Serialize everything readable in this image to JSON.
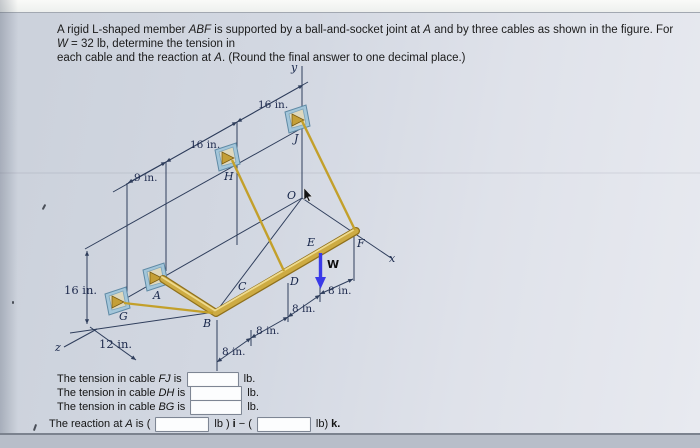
{
  "problem": {
    "l1a": "A rigid L-shaped member ",
    "l1b": "ABF",
    "l1c": " is supported by a ball-and-socket joint at ",
    "l1d": "A",
    "l1e": " and by three cables as shown in the figure. For ",
    "l1f": "W",
    "l1g": " = 32 lb, determine the tension in",
    "l2a": "each cable and the reaction at ",
    "l2b": "A",
    "l2c": ". (Round the final answer to one decimal place.)"
  },
  "figure": {
    "axes": {
      "x": "x",
      "y": "y",
      "z": "z"
    },
    "points": {
      "A": "A",
      "B": "B",
      "C": "C",
      "D": "D",
      "E": "E",
      "F": "F",
      "G": "G",
      "H": "H",
      "J": "J",
      "O": "O"
    },
    "load_label": "W",
    "dims": {
      "d9": "9 in.",
      "d16_top": "16 in.",
      "d16_mid": "16 in.",
      "d16_left": "16 in.",
      "d12": "12 in.",
      "d8_1": "8 in.",
      "d8_2": "8 in.",
      "d8_3": "8 in.",
      "d8_4": "8 in."
    },
    "colors": {
      "line": "#2f3e5c",
      "beam_gold": "#cdab43",
      "beam_edge": "#8f701c",
      "beam_highlight": "#eeda8e",
      "cable": "#c3a02b",
      "anchor_blue": "#a3c6da",
      "anchor_border": "#5f8aa5",
      "anchor_inner": "#ded8bd",
      "bracket_gold": "#c49f37",
      "load_arrow": "#3a3ae8"
    }
  },
  "answers": {
    "row_fj": {
      "prefix": "The tension in cable",
      "cable": "FJ",
      "verb": "is",
      "unit": "lb.",
      "value": ""
    },
    "row_dh": {
      "prefix": "The tension in cable",
      "cable": "DH",
      "verb": "is",
      "unit": "lb.",
      "value": ""
    },
    "row_bg": {
      "prefix": "The tension in cable",
      "cable": "BG",
      "verb": "is",
      "unit": "lb.",
      "value": ""
    },
    "reaction": {
      "prefix": "The reaction at",
      "point": "A",
      "verb": "is (",
      "value_i": "",
      "unit1": "lb )",
      "i": "i",
      "sep": "− (",
      "value_k": "",
      "unit2": "lb)",
      "k": "k."
    }
  }
}
